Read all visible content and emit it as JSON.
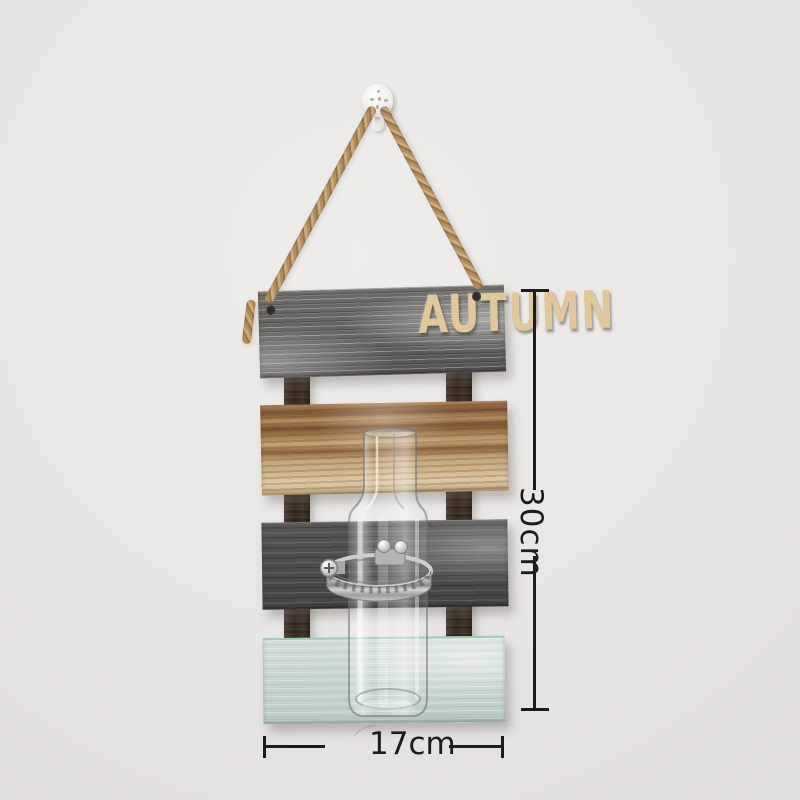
{
  "sign": {
    "title": "AUTUMN"
  },
  "annotations": {
    "height": "30cm",
    "width": "17cm"
  },
  "colors": {
    "wall": "#e8e6e3",
    "ink": "#1c1c1c",
    "letters": "#dfc89c",
    "rail": "#3e3229",
    "plank-gray": "#62615e",
    "plank-dark": "#4c4b49",
    "plank-wood": "#c2a174",
    "plank-mint": "#c9d8cc",
    "rope": "#b9996a",
    "hook": "#f6f5f3",
    "clamp": "#bdbebc"
  }
}
